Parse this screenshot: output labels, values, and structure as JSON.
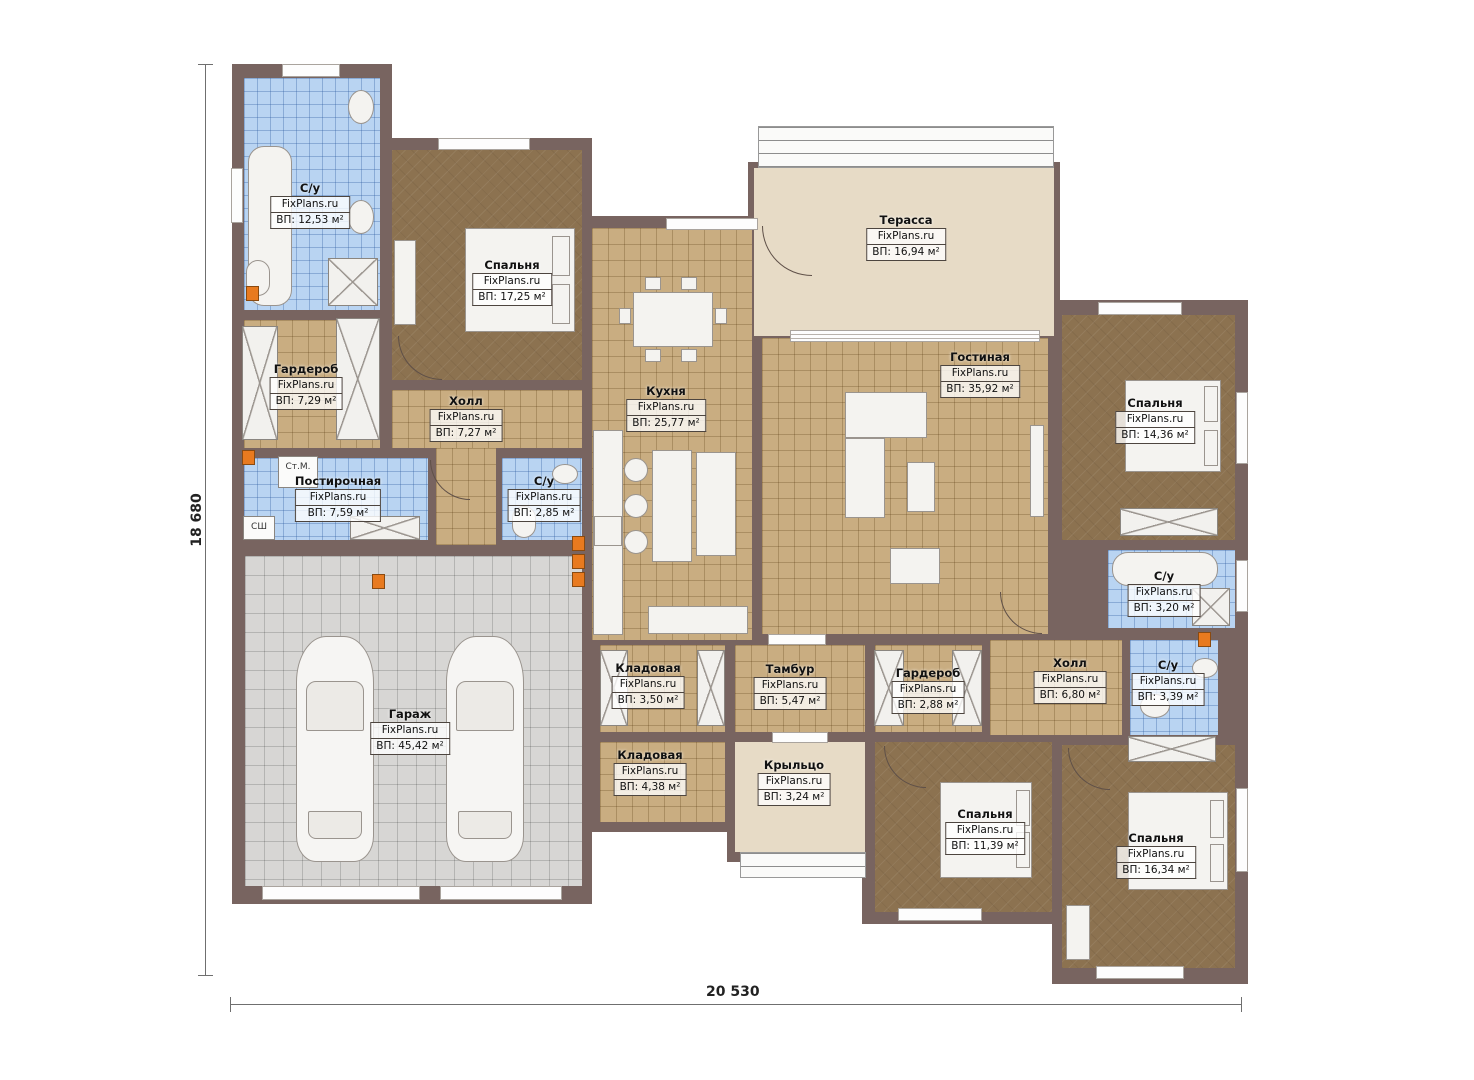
{
  "watermark": "FixPlans.ru",
  "dimensions": {
    "height_label": "18 680",
    "width_label": "20 530"
  },
  "appliances": {
    "washer": "Ст.М.",
    "dryer": "СШ"
  },
  "palette": {
    "wall": "#786460",
    "tile_tan": "#c9ad81",
    "tile_blue": "#b9d4f2",
    "parquet_brown": "#8c7250",
    "garage_gray": "#d7d6d4",
    "terrace_cream": "#e7dbc6",
    "accent_orange": "#e87a1f"
  },
  "rooms": [
    {
      "name": "С/у",
      "area_text": "ВП: 12,53 м²"
    },
    {
      "name": "Спальня",
      "area_text": "ВП: 17,25 м²"
    },
    {
      "name": "Гардероб",
      "area_text": "ВП: 7,29 м²"
    },
    {
      "name": "Холл",
      "area_text": "ВП: 7,27 м²"
    },
    {
      "name": "Постирочная",
      "area_text": "ВП: 7,59 м²"
    },
    {
      "name": "С/у",
      "area_text": "ВП: 2,85 м²"
    },
    {
      "name": "Кухня",
      "area_text": "ВП: 25,77 м²"
    },
    {
      "name": "Терасса",
      "area_text": "ВП: 16,94 м²"
    },
    {
      "name": "Гостиная",
      "area_text": "ВП: 35,92 м²"
    },
    {
      "name": "Спальня",
      "area_text": "ВП: 14,36 м²"
    },
    {
      "name": "С/у",
      "area_text": "ВП: 3,20 м²"
    },
    {
      "name": "Холл",
      "area_text": "ВП: 6,80 м²"
    },
    {
      "name": "С/у",
      "area_text": "ВП: 3,39 м²"
    },
    {
      "name": "Тамбур",
      "area_text": "ВП: 5,47 м²"
    },
    {
      "name": "Гардероб",
      "area_text": "ВП: 2,88 м²"
    },
    {
      "name": "Кладовая",
      "area_text": "ВП: 3,50 м²"
    },
    {
      "name": "Кладовая",
      "area_text": "ВП: 4,38 м²"
    },
    {
      "name": "Крыльцо",
      "area_text": "ВП: 3,24 м²"
    },
    {
      "name": "Гараж",
      "area_text": "ВП: 45,42 м²"
    },
    {
      "name": "Спальня",
      "area_text": "ВП: 11,39 м²"
    },
    {
      "name": "Спальня",
      "area_text": "ВП: 16,34 м²"
    }
  ]
}
